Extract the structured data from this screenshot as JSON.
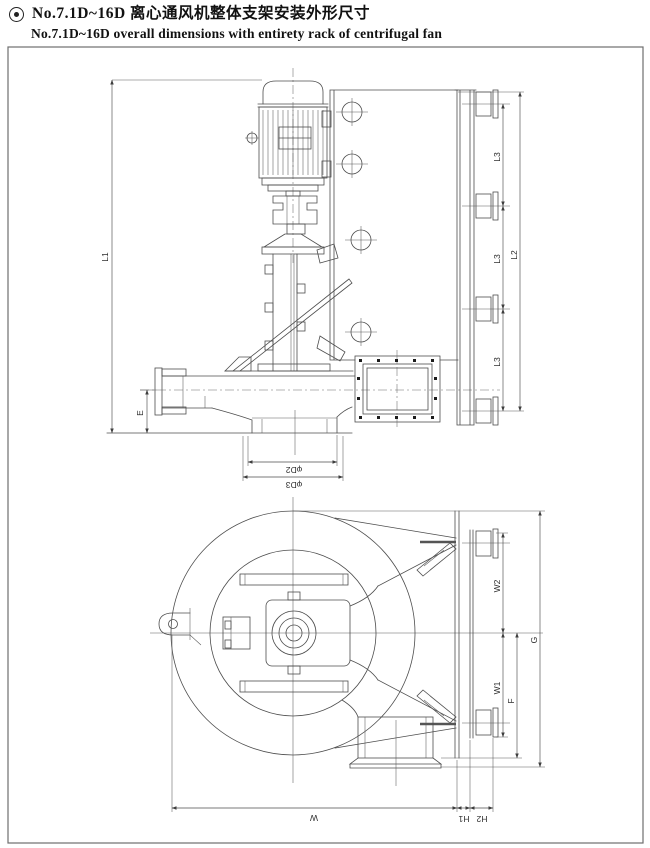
{
  "header": {
    "bullet_icon": "double-circle-bullet",
    "title_cn": "No.7.1D~16D 离心通风机整体支架安装外形尺寸",
    "title_en": "No.7.1D~16D overall dimensions with entirety rack  of centrifugal fan"
  },
  "side_view": {
    "description": "side elevation of centrifugal fan with vertical motor, bearing pedestal, inlet pipe, wall mounting plate and rail with four clamps",
    "dims": {
      "L1": "L1",
      "L2": "L2",
      "L3": "L3",
      "E": "E",
      "D2": "φD2",
      "D3": "φD3"
    }
  },
  "plan_view": {
    "description": "plan view of scroll casing, bearing hub, outlet cone to mounting rail and downward discharge duct",
    "dims": {
      "W2": "W2",
      "W1": "W1",
      "F": "F",
      "G": "G",
      "W": "W",
      "H1": "H1",
      "H2": "H2"
    }
  },
  "colors": {
    "line": "#4d4d4d",
    "text": "#2e2e2e",
    "background": "#ffffff",
    "border": "#6e6e6e"
  }
}
